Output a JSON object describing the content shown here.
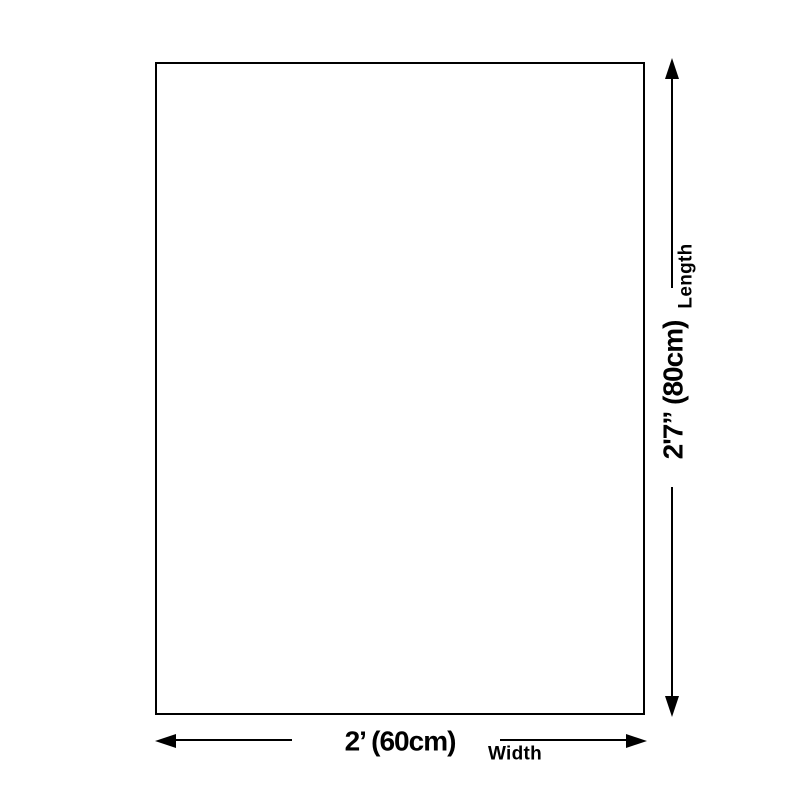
{
  "diagram": {
    "length": {
      "label": "Length",
      "value": "2'7” (80cm)"
    },
    "width": {
      "label": "Width",
      "value": "2’ (60cm)"
    },
    "colors": {
      "line": "#000000",
      "background": "#ffffff",
      "surface": "#ffffff"
    }
  }
}
